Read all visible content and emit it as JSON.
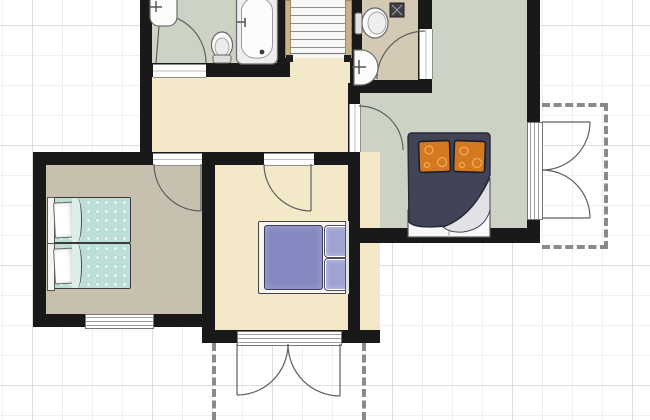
{
  "canvas": {
    "width": 650,
    "height": 420,
    "grid_minor_px": 30,
    "grid_major_px": 120
  },
  "colors": {
    "wall": "#191919",
    "grid_minor": "#efefef",
    "grid_major": "#dedede",
    "floor_bathroom": "#ccd3c5",
    "floor_bedroom_right": "#ccd3c5",
    "floor_wc": "#d3c9b4",
    "floor_bedroom_left": "#c7c0ae",
    "floor_hallway": "#f3e9c9",
    "floor_bedroom_middle": "#f3e9c9",
    "duvet_right_bed": "#414357",
    "pillows_right_bed": "#d5791f",
    "blanket_twin_beds": "#bcded6",
    "duvet_middle_bed": "#8488c0",
    "stair_stringer": "#c9b189",
    "balcony_border": "#8a8a8a",
    "fixture_fill": "#fbfbfb",
    "fixture_stroke": "#6e6e6e"
  },
  "rooms": [
    {
      "id": "bathroom",
      "label": "bathroom with bathtub, toilet and sink",
      "floor": "floor_bathroom"
    },
    {
      "id": "wc",
      "label": "wc with toilet, sink and floor drain",
      "floor": "floor_wc"
    },
    {
      "id": "hallway",
      "label": "hallway with staircase",
      "floor": "floor_hallway"
    },
    {
      "id": "bedroom-left",
      "label": "bedroom with two twin beds",
      "floor": "floor_bedroom_left"
    },
    {
      "id": "bedroom-middle",
      "label": "bedroom with double bed",
      "floor": "floor_bedroom_middle"
    },
    {
      "id": "bedroom-right",
      "label": "bedroom with double bed and orange pillows",
      "floor": "floor_bedroom_right"
    }
  ],
  "furniture": [
    {
      "id": "staircase",
      "treads": 7
    },
    {
      "id": "bathtub"
    },
    {
      "id": "bathroom-toilet"
    },
    {
      "id": "bathroom-sink"
    },
    {
      "id": "wc-toilet"
    },
    {
      "id": "wc-sink"
    },
    {
      "id": "wc-floor-drain"
    },
    {
      "id": "twin-bed-1"
    },
    {
      "id": "twin-bed-2"
    },
    {
      "id": "double-bed-middle",
      "pillows": 2
    },
    {
      "id": "double-bed-right",
      "pillows": 2
    }
  ],
  "openings": [
    {
      "id": "bathroom-door",
      "type": "door"
    },
    {
      "id": "wc-door",
      "type": "door"
    },
    {
      "id": "bedroom-left-door",
      "type": "door"
    },
    {
      "id": "bedroom-middle-door",
      "type": "door"
    },
    {
      "id": "bedroom-right-door",
      "type": "door"
    },
    {
      "id": "bedroom-left-window",
      "type": "window"
    },
    {
      "id": "balcony-right-french-door",
      "type": "double-door"
    },
    {
      "id": "balcony-bottom-french-door",
      "type": "double-door"
    }
  ],
  "balconies": [
    {
      "id": "balcony-right"
    },
    {
      "id": "balcony-bottom"
    }
  ]
}
